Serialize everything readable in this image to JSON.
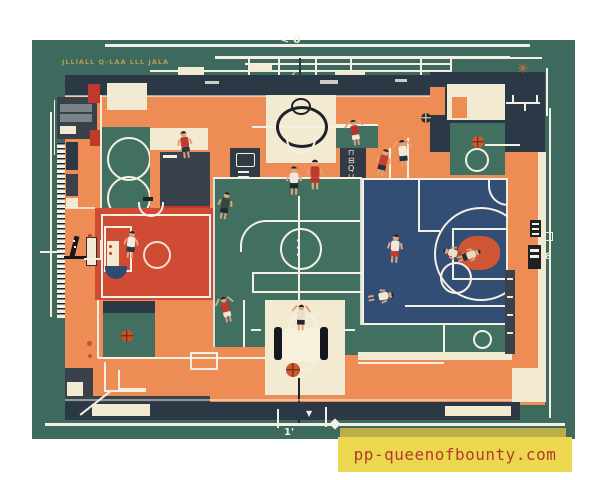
{
  "meta": {
    "title": "Aerial blueprint-style illustration of basketball courts with players"
  },
  "palette": {
    "page_bg": "#ffffff",
    "board": "#3e695f",
    "court_teal": "#427060",
    "orange": "#ee8c55",
    "cream": "#f3ead2",
    "navy": "#2b3947",
    "charcoal": "#39424b",
    "red_court": "#d04b34",
    "blue_court": "#334e74",
    "key_orange": "#cf5635",
    "line": "#f4f1e4",
    "olive": "#b0a14c",
    "skin": "#dfa27d",
    "ball_orange": "#cb5630",
    "banner_yellow": "#ecd84f",
    "banner_olive": "#b9ae4a",
    "banner_text": "#b53a2c"
  },
  "annotations": {
    "spec_note": "JLLlALL  Q–LAA   LLL  JALA",
    "top_marker": "< 0",
    "tick_mark": "✓",
    "right_dim": "8",
    "bottom_dim": "1'",
    "glyph_panel": "⊓⊟Q⊔",
    "asterisk": "✳"
  },
  "watermark": {
    "text": "pp-queenofbounty.com"
  },
  "players": [
    {
      "x": 179,
      "y": 131,
      "jersey": "#bf3a2e",
      "shorts": "#2b3947",
      "pose": "run",
      "rot": -8,
      "s": 1
    },
    {
      "x": 219,
      "y": 192,
      "jersey": "#33493d",
      "shorts": "#222a31",
      "pose": "run",
      "rot": 10,
      "s": 1
    },
    {
      "x": 288,
      "y": 167,
      "jersey": "#efe9da",
      "shorts": "#23282e",
      "pose": "stand",
      "rot": 0,
      "s": 1.05
    },
    {
      "x": 309,
      "y": 161,
      "jersey": "#c03a2d",
      "shorts": "#b5372b",
      "pose": "stand",
      "rot": 0,
      "s": 1.1
    },
    {
      "x": 349,
      "y": 119,
      "jersey": "#b5342c",
      "shorts": "#f2e9d4",
      "pose": "arms-up",
      "rot": -10,
      "s": 0.95
    },
    {
      "x": 377,
      "y": 149,
      "jersey": "#c6402f",
      "shorts": "#27313c",
      "pose": "run",
      "rot": 14,
      "s": 1
    },
    {
      "x": 397,
      "y": 140,
      "jersey": "#f1ead6",
      "shorts": "#27313c",
      "pose": "arms-up",
      "rot": -6,
      "s": 1
    },
    {
      "x": 389,
      "y": 235,
      "jersey": "#f2ead8",
      "shorts": "#c23b30",
      "pose": "run",
      "rot": 4,
      "s": 1.05
    },
    {
      "x": 375,
      "y": 283,
      "jersey": "#f1e9d4",
      "shorts": "#2e4a6e",
      "pose": "run",
      "rot": 80,
      "s": 0.95
    },
    {
      "x": 295,
      "y": 304,
      "jersey": "#e8e0ce",
      "shorts": "#23282e",
      "pose": "arms-up",
      "rot": 2,
      "s": 0.95
    },
    {
      "x": 220,
      "y": 296,
      "jersey": "#c03a2d",
      "shorts": "#f0e7d2",
      "pose": "arms-up",
      "rot": -14,
      "s": 0.95
    },
    {
      "x": 125,
      "y": 231,
      "jersey": "#f3eee2",
      "shorts": "#2b3947",
      "pose": "stand",
      "rot": 6,
      "s": 1
    },
    {
      "x": 449,
      "y": 240,
      "jersey": "#f0dfc4",
      "shorts": "#b8492e",
      "pose": "run",
      "rot": -75,
      "s": 0.9
    },
    {
      "x": 463,
      "y": 242,
      "jersey": "#e9d9c0",
      "shorts": "#27313c",
      "pose": "run",
      "rot": 70,
      "s": 0.9
    }
  ],
  "balls": [
    {
      "x": 421,
      "y": 113,
      "d": 10,
      "color": "#3a2a24",
      "seam": "#e8e4d8"
    },
    {
      "x": 472,
      "y": 136,
      "d": 12,
      "color": "#cd5a2d",
      "seam": "#5a2617"
    },
    {
      "x": 121,
      "y": 330,
      "d": 12,
      "color": "#c8502b",
      "seam": "#5a2617"
    },
    {
      "x": 286,
      "y": 363,
      "d": 14,
      "color": "#cb5630",
      "seam": "#5a2617"
    }
  ]
}
